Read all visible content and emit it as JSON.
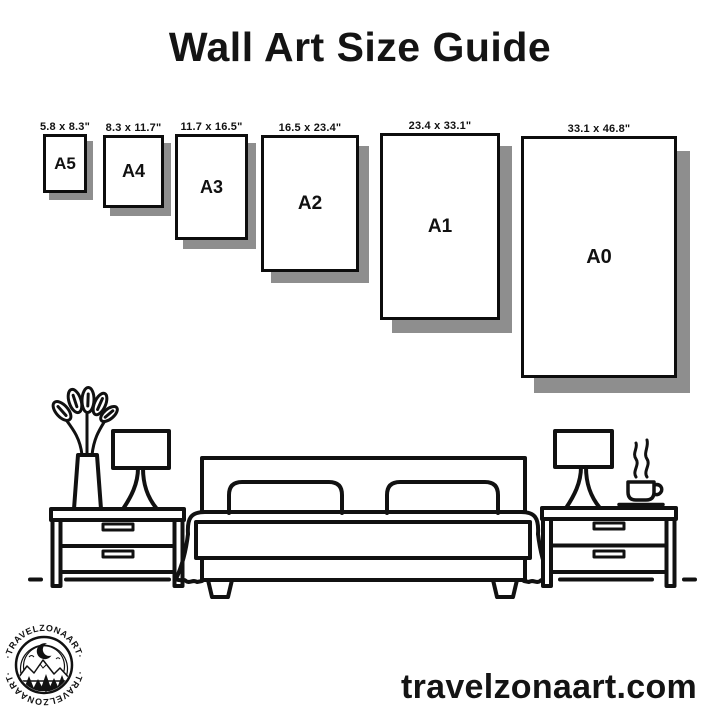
{
  "title": "Wall Art Size Guide",
  "frames": [
    {
      "name": "A5",
      "dimensions": "5.8 x 8.3\""
    },
    {
      "name": "A4",
      "dimensions": "8.3 x 11.7\""
    },
    {
      "name": "A3",
      "dimensions": "11.7 x 16.5\""
    },
    {
      "name": "A2",
      "dimensions": "16.5 x 23.4\""
    },
    {
      "name": "A1",
      "dimensions": "23.4 x 33.1\""
    },
    {
      "name": "A0",
      "dimensions": "33.1 x 46.8\""
    }
  ],
  "illustration": {
    "scene": "bedroom-line-art",
    "items": [
      "potted-plant",
      "table-lamp",
      "nightstand",
      "double-bed",
      "nightstand",
      "table-lamp",
      "coffee-cup"
    ]
  },
  "logo": {
    "arc_text_top": "·TRAVELZONAART·",
    "arc_text_bottom": "·TRAVELZONAART·"
  },
  "footer": {
    "website": "travelzonaart.com"
  },
  "colors": {
    "ink": "#111111",
    "frame_shadow": "#8e8e8e",
    "background": "#ffffff"
  }
}
